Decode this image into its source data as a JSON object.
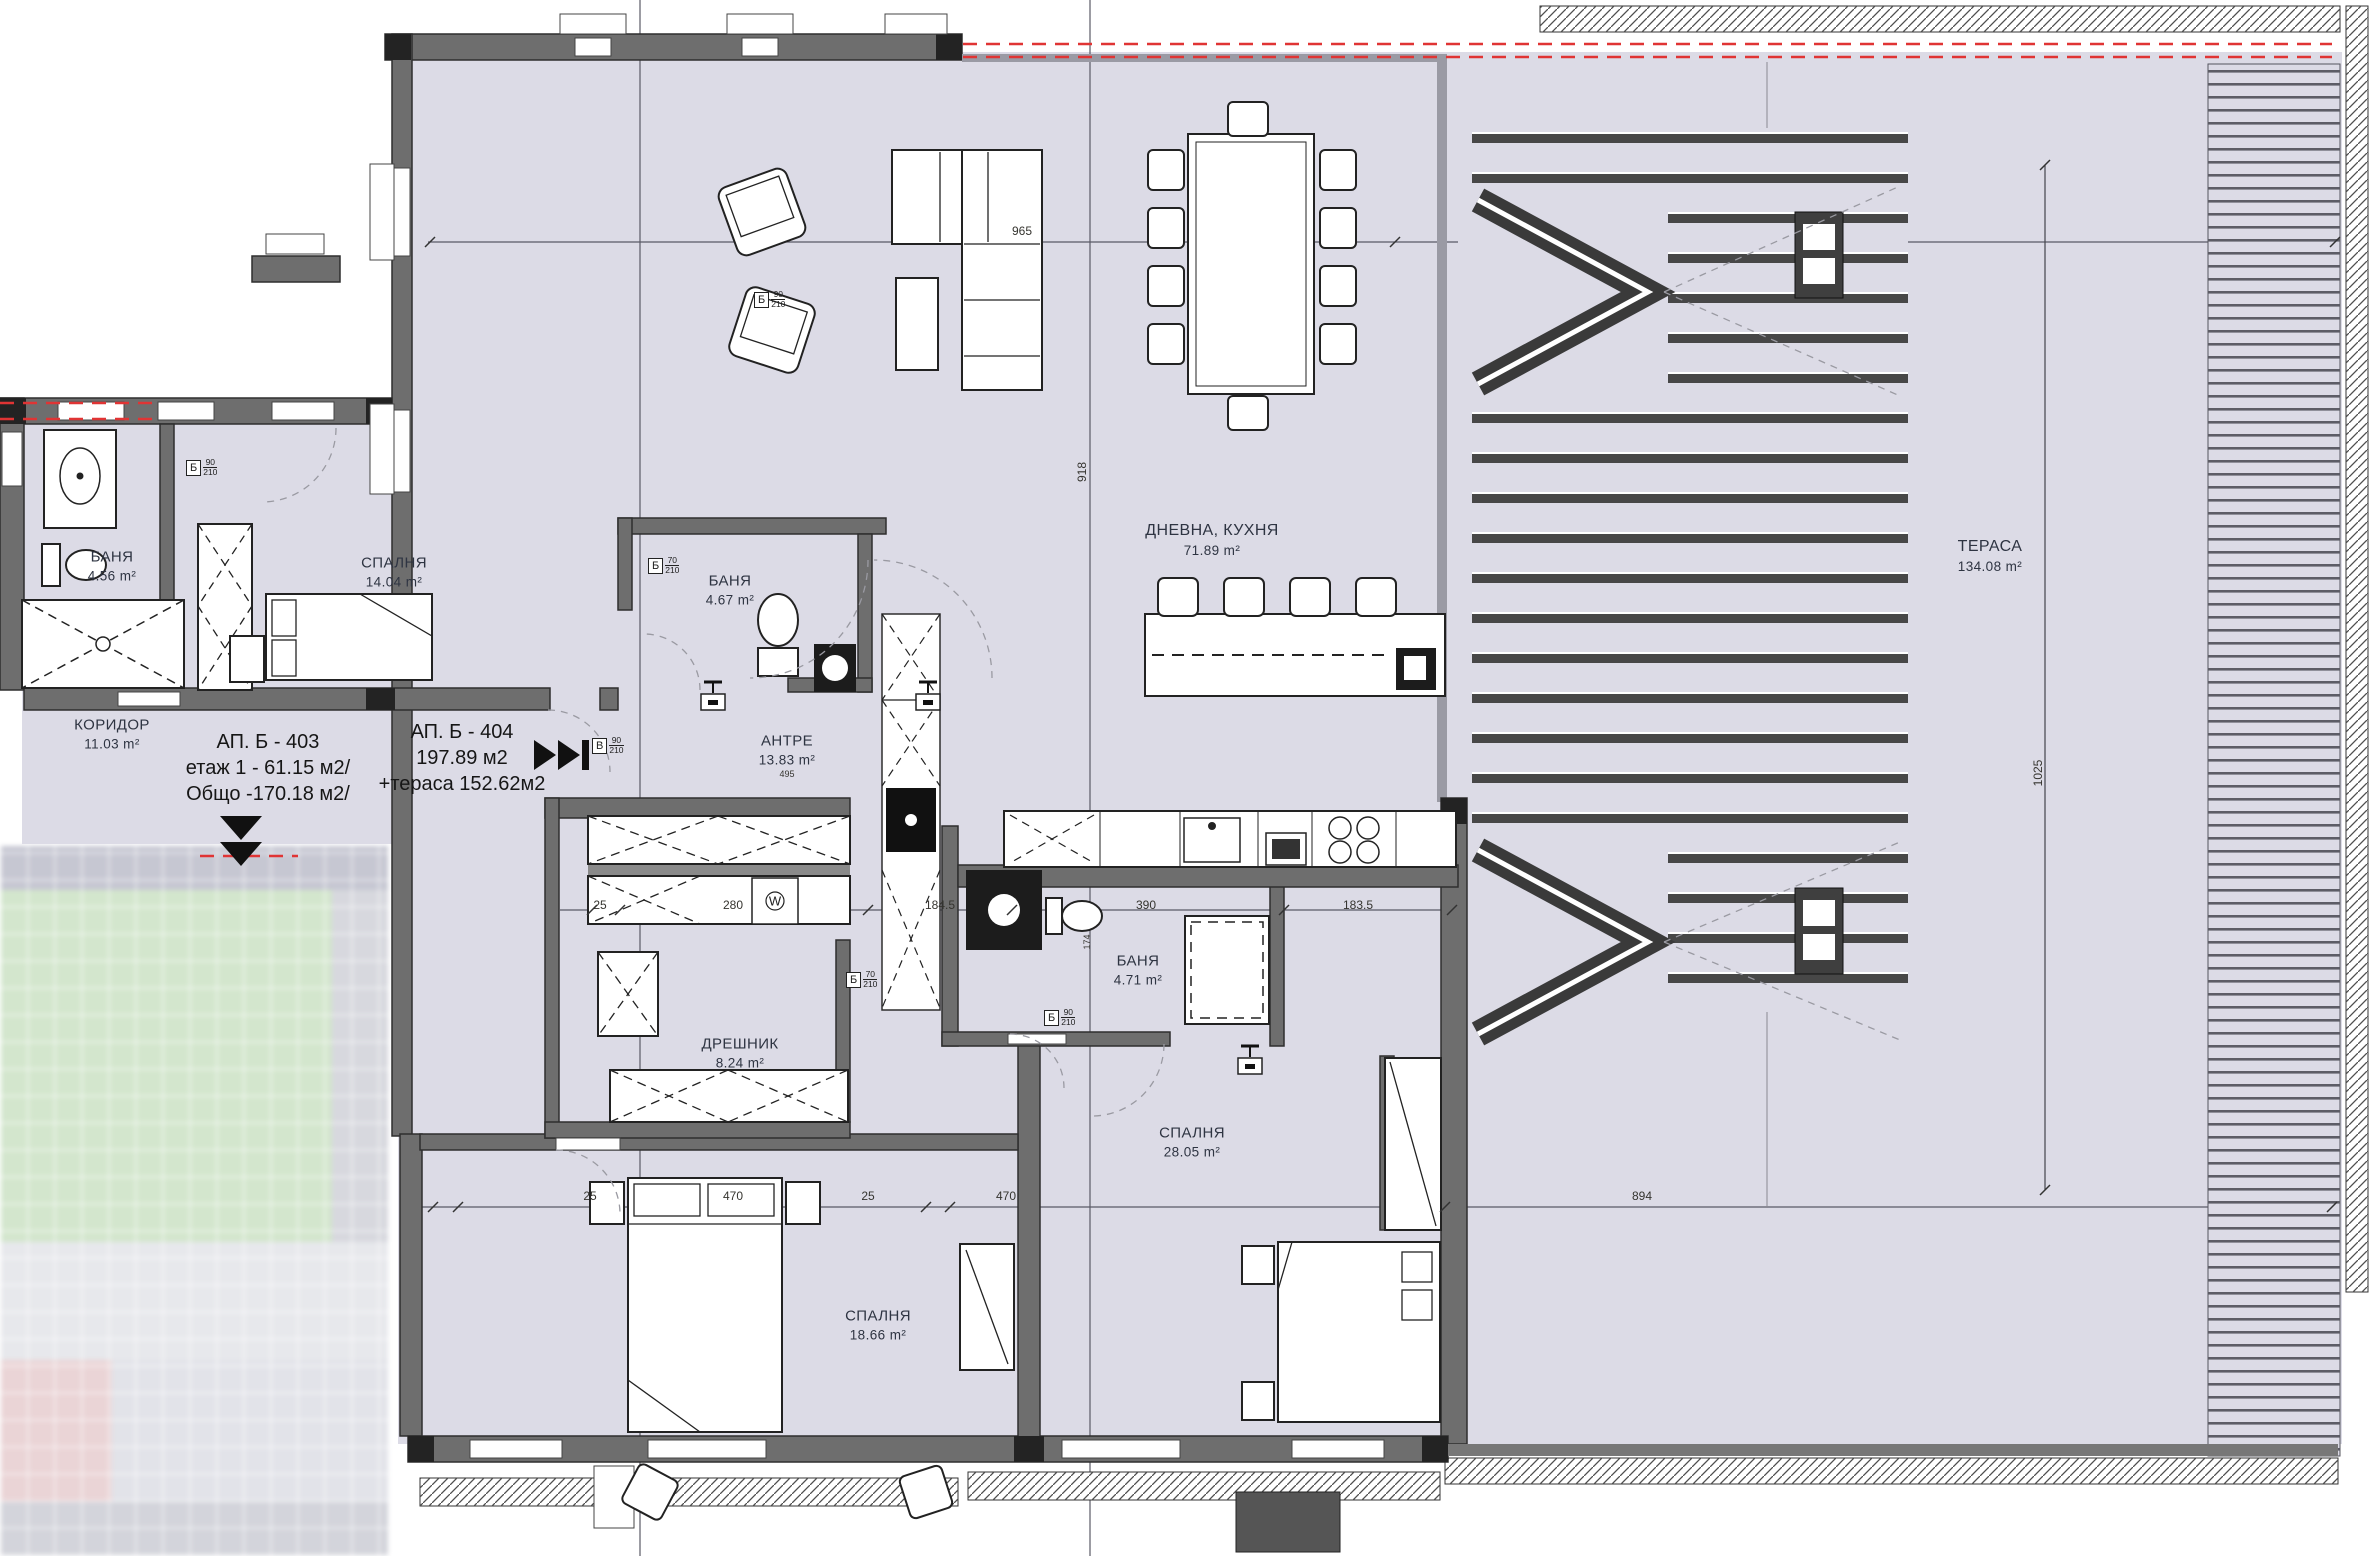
{
  "apartments": {
    "b403": {
      "line1": "АП. Б - 403",
      "line2": "етаж 1 - 61.15 м2/",
      "line3": "Общо -170.18  м2/"
    },
    "b404": {
      "line1": "АП. Б - 404",
      "line2": "197.89 м2",
      "line3": "+тераса 152.62м2"
    }
  },
  "rooms": {
    "koridor": {
      "name": "КОРИДОР",
      "area": "11.03 m²"
    },
    "spalnya14": {
      "name": "СПАЛНЯ",
      "area": "14.04 m²"
    },
    "banya1": {
      "name": "БАНЯ",
      "area": "4.56 m²"
    },
    "banya2": {
      "name": "БАНЯ",
      "area": "4.67 m²"
    },
    "antre": {
      "name": "АНТРЕ",
      "area": "13.83 m²"
    },
    "dnevna": {
      "name": "ДНЕВНА, КУХНЯ",
      "area": "71.89 m²"
    },
    "terasa": {
      "name": "ТЕРАСА",
      "area": "134.08 m²"
    },
    "dreshnik": {
      "name": "ДРЕШНИК",
      "area": "8.24 m²"
    },
    "banya3": {
      "name": "БАНЯ",
      "area": "4.71 m²"
    },
    "spalnya28": {
      "name": "СПАЛНЯ",
      "area": "28.05 m²"
    },
    "spalnya18": {
      "name": "СПАЛНЯ",
      "area": "18.66 m²"
    }
  },
  "dimensions": {
    "d965": "965",
    "d918": "918",
    "d894": "894",
    "d1025": "1025",
    "d25a": "25",
    "d280": "280",
    "d1845": "184.5",
    "d390": "390",
    "d1835": "183.5",
    "d25b": "25",
    "d470a": "470",
    "d25c": "25",
    "d470b": "470",
    "d174": "174",
    "d495": "495"
  },
  "door_tags": {
    "t1": {
      "letter": "Б",
      "w": "90",
      "h": "210"
    },
    "t2": {
      "letter": "Б",
      "w": "70",
      "h": "210"
    },
    "t3": {
      "letter": "Б",
      "w": "70",
      "h": "210"
    },
    "t4": {
      "letter": "В",
      "w": "90",
      "h": "210"
    },
    "t5": {
      "letter": "Б",
      "w": "90",
      "h": "210"
    },
    "t6": {
      "letter": "Б",
      "w": "90",
      "h": "210"
    }
  },
  "appliances": {
    "washer": "W"
  },
  "colors": {
    "floor": "#dcdbe6",
    "wall": "#6e6e6e",
    "red_dash": "#e03434"
  }
}
